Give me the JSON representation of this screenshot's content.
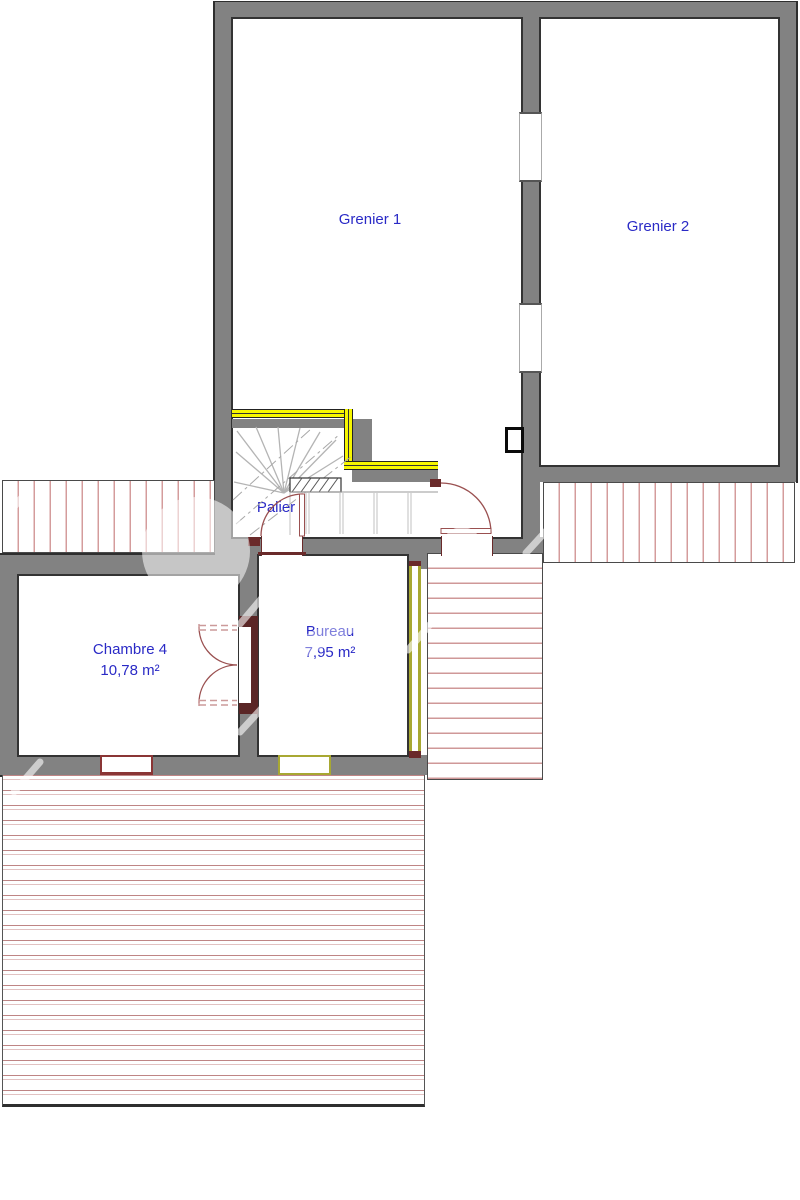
{
  "plan": {
    "kind": "attic floor plan",
    "rooms": {
      "grenier1": {
        "label": "Grenier 1"
      },
      "grenier2": {
        "label": "Grenier 2"
      },
      "palier": {
        "label": "Palier"
      },
      "chambre4": {
        "label": "Chambre 4",
        "area": "10,78 m²"
      },
      "bureau": {
        "label": "Bureau",
        "area": "7,95 m²"
      }
    },
    "colors": {
      "wall_gray": "#828282",
      "outline": "#2e2e2e",
      "hatch_pink": "#d49c9c",
      "guardrail_yellow": "#f6f600",
      "glazing_olive": "#a8a832",
      "door_swing_red": "#9a5050",
      "door_frame_brown": "#5a2626",
      "room_label_blue": "#2a2ac6"
    }
  }
}
